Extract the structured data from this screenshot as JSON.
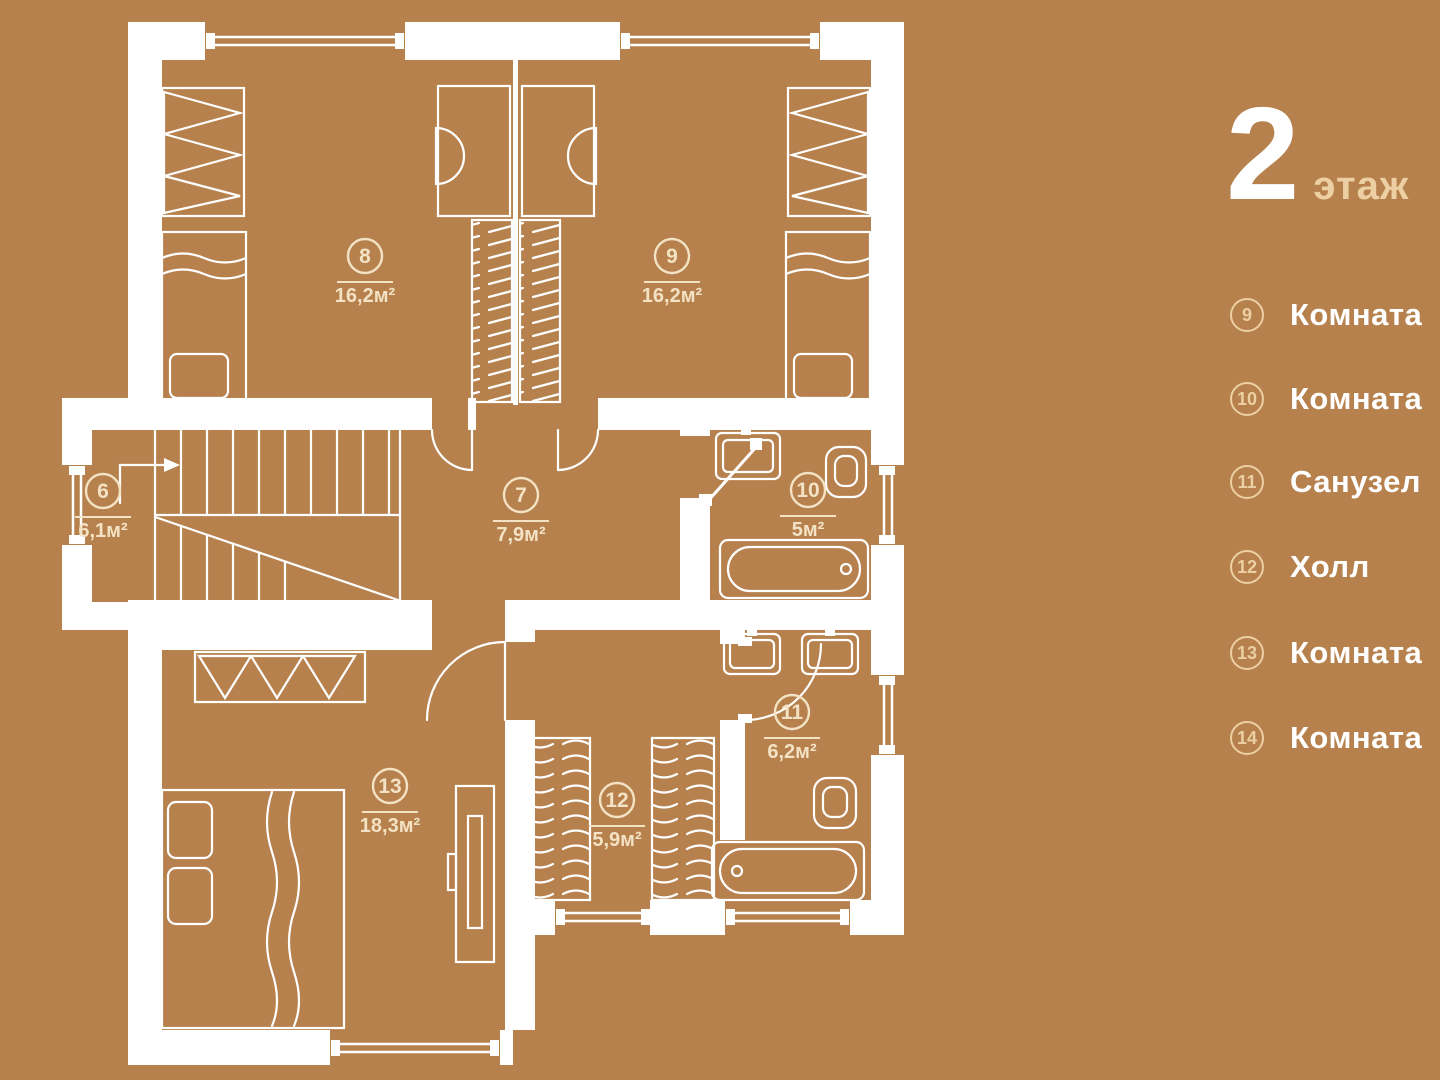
{
  "title": {
    "number": "2",
    "suffix": "этаж"
  },
  "legend": {
    "items": [
      {
        "num": "9",
        "label": "Комната"
      },
      {
        "num": "10",
        "label": "Комната"
      },
      {
        "num": "11",
        "label": "Санузел"
      },
      {
        "num": "12",
        "label": "Холл"
      },
      {
        "num": "13",
        "label": "Комната"
      },
      {
        "num": "14",
        "label": "Комната"
      }
    ]
  },
  "plan": {
    "rooms": [
      {
        "num": "6",
        "area": "6,1м²"
      },
      {
        "num": "7",
        "area": "7,9м²"
      },
      {
        "num": "8",
        "area": "16,2м²"
      },
      {
        "num": "9",
        "area": "16,2м²"
      },
      {
        "num": "10",
        "area": "5м²"
      },
      {
        "num": "11",
        "area": "6,2м²"
      },
      {
        "num": "12",
        "area": "5,9м²"
      },
      {
        "num": "13",
        "area": "18,3м²"
      }
    ]
  },
  "colors": {
    "background": "#b6814d",
    "wall": "#ffffff",
    "plan_label": "#f3e2c4",
    "accent": "#eccfa2",
    "legend_text": "#ffffff"
  }
}
